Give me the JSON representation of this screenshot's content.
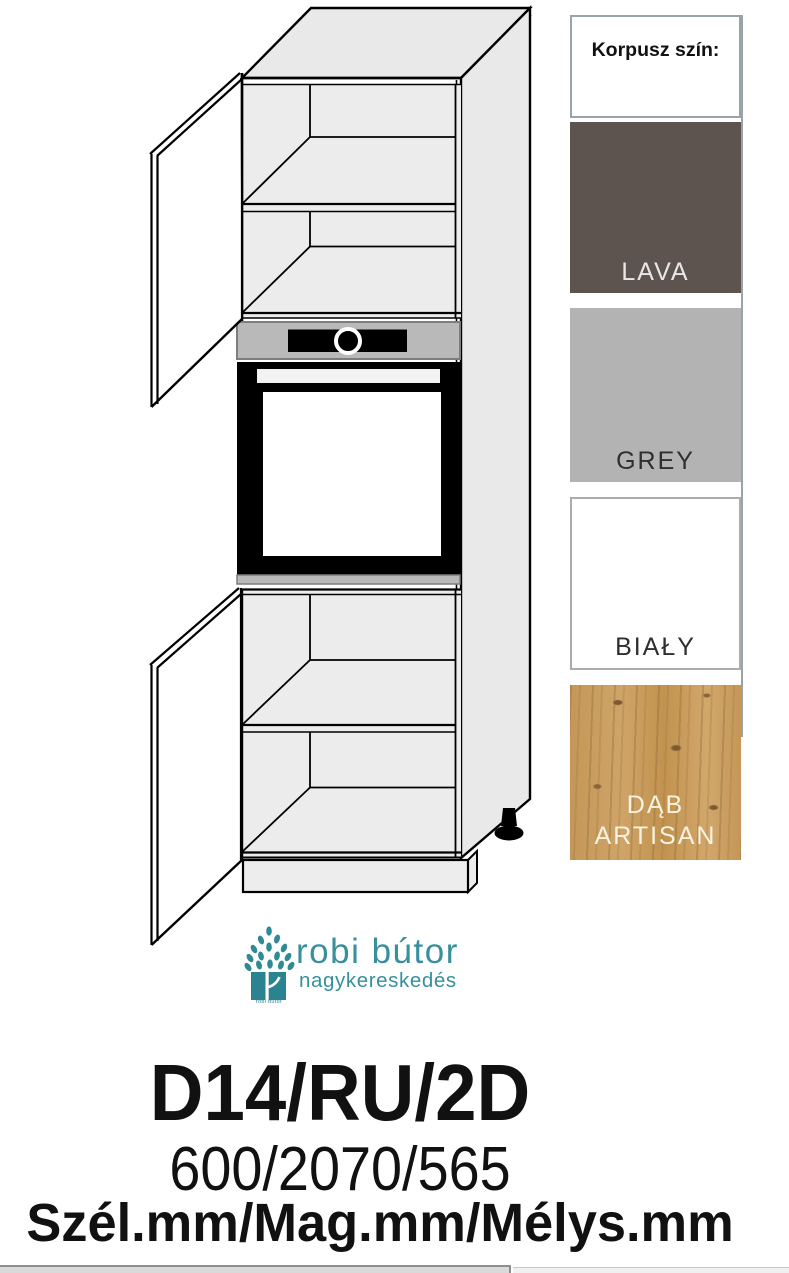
{
  "swatch_panel": {
    "title": "Korpusz szín:",
    "swatches": [
      {
        "name": "LAVA",
        "color": "#5d534f",
        "text_color": "#e9e7e6"
      },
      {
        "name": "GREY",
        "color": "#b3b3b3",
        "text_color": "#2f2f2f"
      },
      {
        "name": "BIAŁY",
        "color": "#ffffff",
        "text_color": "#2f2f2f"
      },
      {
        "name": "DĄB ARTISAN",
        "color": "#c89d60",
        "text_color": "#f8f3e0"
      }
    ]
  },
  "logo": {
    "brand": "robi bútor",
    "subtitle": "nagykereskedés",
    "icon_caption": "robi bútor",
    "brand_color": "#37909c"
  },
  "product": {
    "code": "D14/RU/2D",
    "dimensions": "600/2070/565",
    "dimensions_label": "Szél.mm/Mag.mm/Mélys.mm"
  }
}
